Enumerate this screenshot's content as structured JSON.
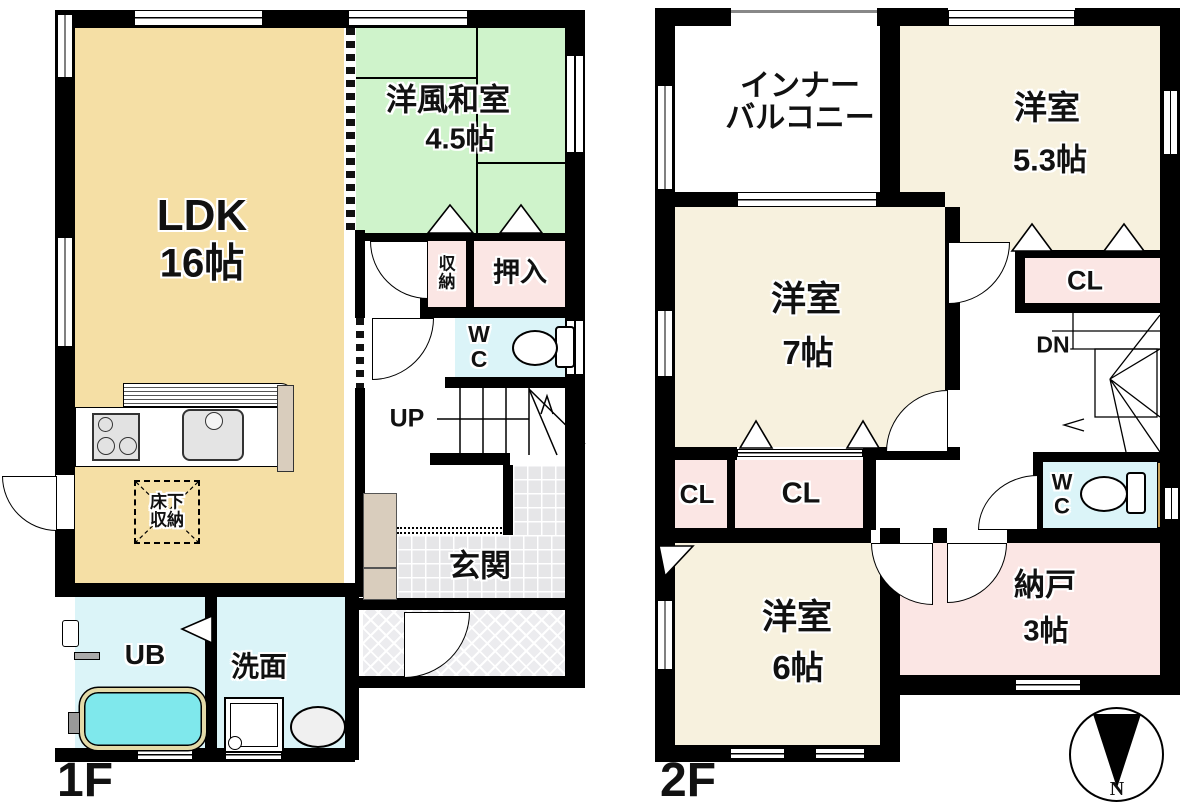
{
  "floor1": {
    "label": "1F",
    "rooms": {
      "ldk": {
        "name": "LDK",
        "size": "16帖"
      },
      "washitsu": {
        "name": "洋風和室",
        "size": "4.5帖"
      },
      "shuno": {
        "line1": "収",
        "line2": "納"
      },
      "oshiire": {
        "name": "押入"
      },
      "wc": {
        "line1": "W",
        "line2": "C"
      },
      "stairs": {
        "label": "UP"
      },
      "genkan": {
        "name": "玄関"
      },
      "yukashita": {
        "line1": "床下",
        "line2": "収納"
      },
      "ub": {
        "name": "UB"
      },
      "senmen": {
        "name": "洗面"
      }
    }
  },
  "floor2": {
    "label": "2F",
    "rooms": {
      "balcony": {
        "line1": "インナー",
        "line2": "バルコニー"
      },
      "west53": {
        "name": "洋室",
        "size": "5.3帖"
      },
      "cl53": {
        "name": "CL"
      },
      "west7": {
        "name": "洋室",
        "size": "7帖"
      },
      "stairs": {
        "label": "DN"
      },
      "cl_a": {
        "name": "CL"
      },
      "cl_b": {
        "name": "CL"
      },
      "wc": {
        "line1": "W",
        "line2": "C"
      },
      "west6": {
        "name": "洋室",
        "size": "6帖"
      },
      "nando": {
        "name": "納戸",
        "size": "3帖"
      }
    }
  },
  "compass": {
    "north": "N"
  },
  "colors": {
    "wall": "#000000",
    "tan": "#F5DFA5",
    "cream": "#F7F1DE",
    "green": "#CFF3CB",
    "pink": "#FBE6E4",
    "blue": "#DBF4F8",
    "tub": "#7FE8EC",
    "tile": "#E6E6E8",
    "wood": "#E7CE96",
    "cab": "#D9CDBD"
  }
}
